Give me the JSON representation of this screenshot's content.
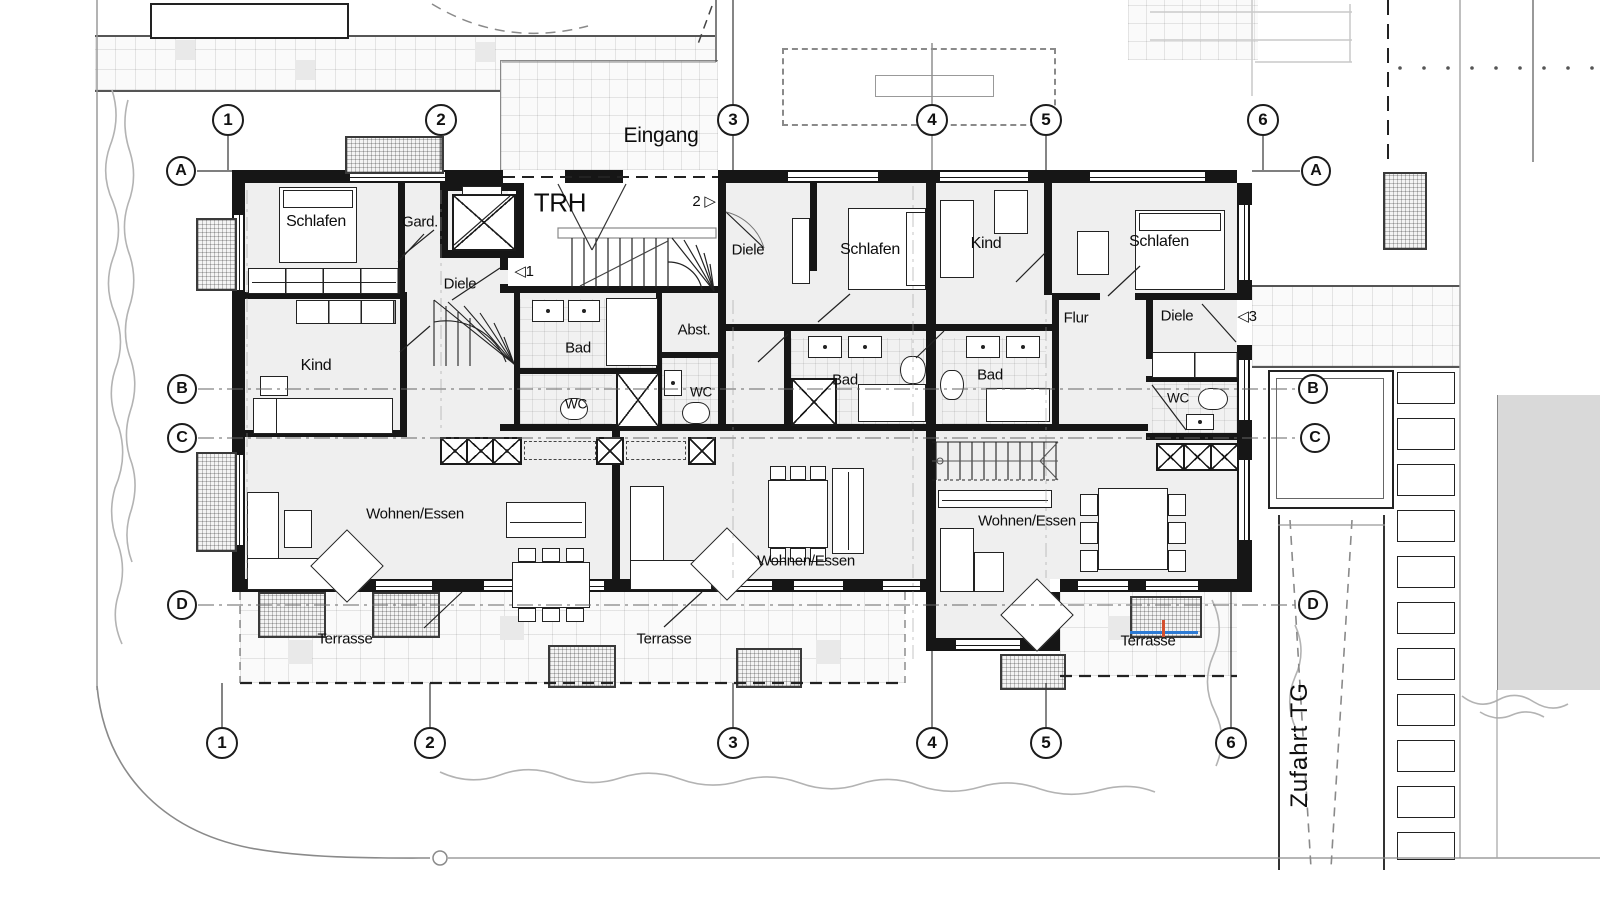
{
  "plan": {
    "site": {
      "eingang": "Eingang",
      "zufahrt": "Zufahrt TG"
    },
    "rooms": {
      "trh": "TRH",
      "schlafen": "Schlafen",
      "gard": "Gard.",
      "diele": "Diele",
      "kind": "Kind",
      "bad": "Bad",
      "wc": "WC",
      "abst": "Abst.",
      "flur": "Flur",
      "wohnen": "Wohnen/Essen",
      "terrasse": "Terrasse"
    },
    "doors": {
      "d1": "◁1",
      "d2": "2 ▷",
      "d3": "◁3"
    },
    "grid": {
      "cols": [
        "1",
        "2",
        "3",
        "4",
        "5",
        "6"
      ],
      "rows": [
        "A",
        "B",
        "C",
        "D"
      ]
    },
    "colors": {
      "wall": "#161616",
      "accent_blue": "#2e7bd4",
      "accent_red": "#d4502e",
      "site_gray": "#b0b0b0"
    }
  }
}
